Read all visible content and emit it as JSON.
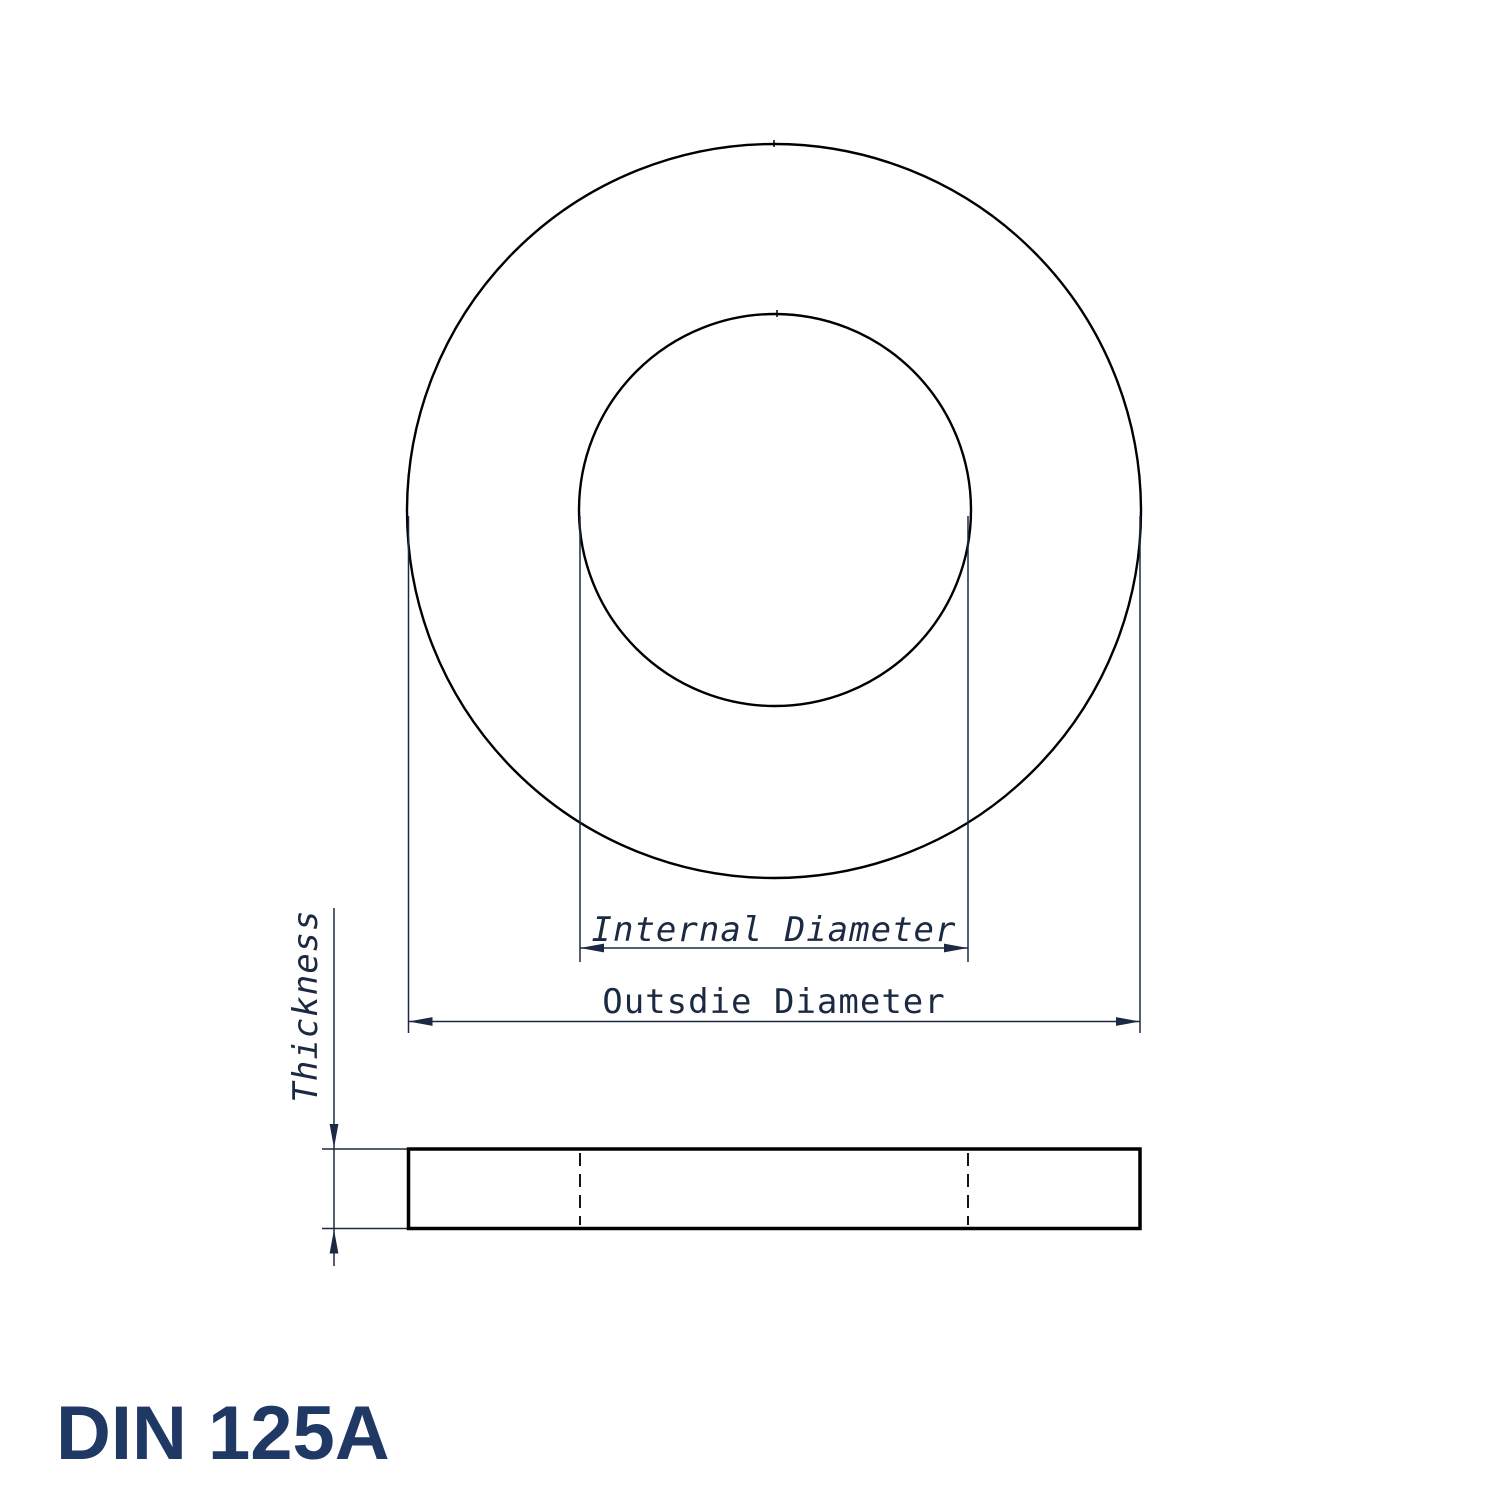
{
  "title": {
    "label": "DIN 125A"
  },
  "labels": {
    "internal_diameter": "Internal Diameter",
    "outside_diameter": "Outsdie Diameter",
    "thickness": "Thickness"
  },
  "colors": {
    "background": "#ffffff",
    "part_outline": "#000000",
    "dimension_lines_and_text": "#1b2a42",
    "title_text": "#1f3864"
  },
  "drawing": {
    "type": "technical-drawing",
    "standard": "DIN 125A",
    "subject": "flat-washer",
    "views": [
      {
        "name": "top-view",
        "elements": [
          "outer-circle",
          "inner-hole-circle"
        ]
      },
      {
        "name": "side-section-view",
        "elements": [
          "washer-rectangle",
          "hidden-hole-dashed-lines"
        ]
      }
    ],
    "dimensions_called_out": [
      "Internal Diameter",
      "Outsdie Diameter",
      "Thickness"
    ]
  }
}
